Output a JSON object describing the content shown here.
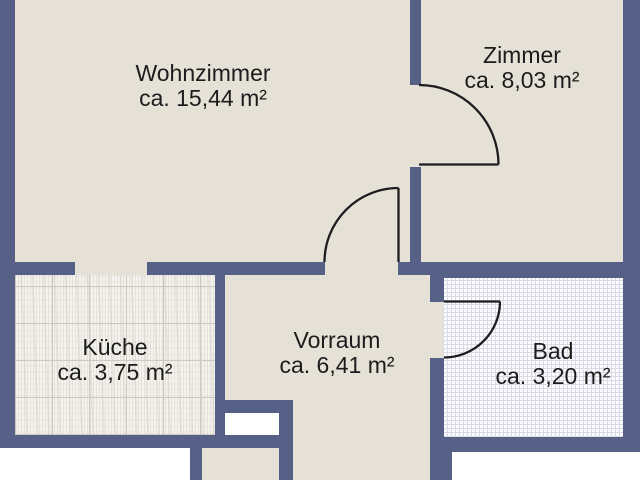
{
  "rooms": [
    {
      "id": "wohnzimmer",
      "name": "Wohnzimmer",
      "area": "ca. 15,44 m²"
    },
    {
      "id": "zimmer",
      "name": "Zimmer",
      "area": "ca. 8,03 m²"
    },
    {
      "id": "kueche",
      "name": "Küche",
      "area": "ca. 3,75 m²"
    },
    {
      "id": "vorraum",
      "name": "Vorraum",
      "area": "ca. 6,41 m²"
    },
    {
      "id": "bad",
      "name": "Bad",
      "area": "ca. 3,20 m²"
    }
  ],
  "colors": {
    "wall": "#576086",
    "floor": "#e5e1d7",
    "outside": "#ffffff",
    "tile_kueche": "#f5f3ee",
    "grid_kueche": "#ccc9c0",
    "tile_bad": "#fcfcfe",
    "grid_bad": "#d8dbe6",
    "door_line": "#1d1d20"
  }
}
